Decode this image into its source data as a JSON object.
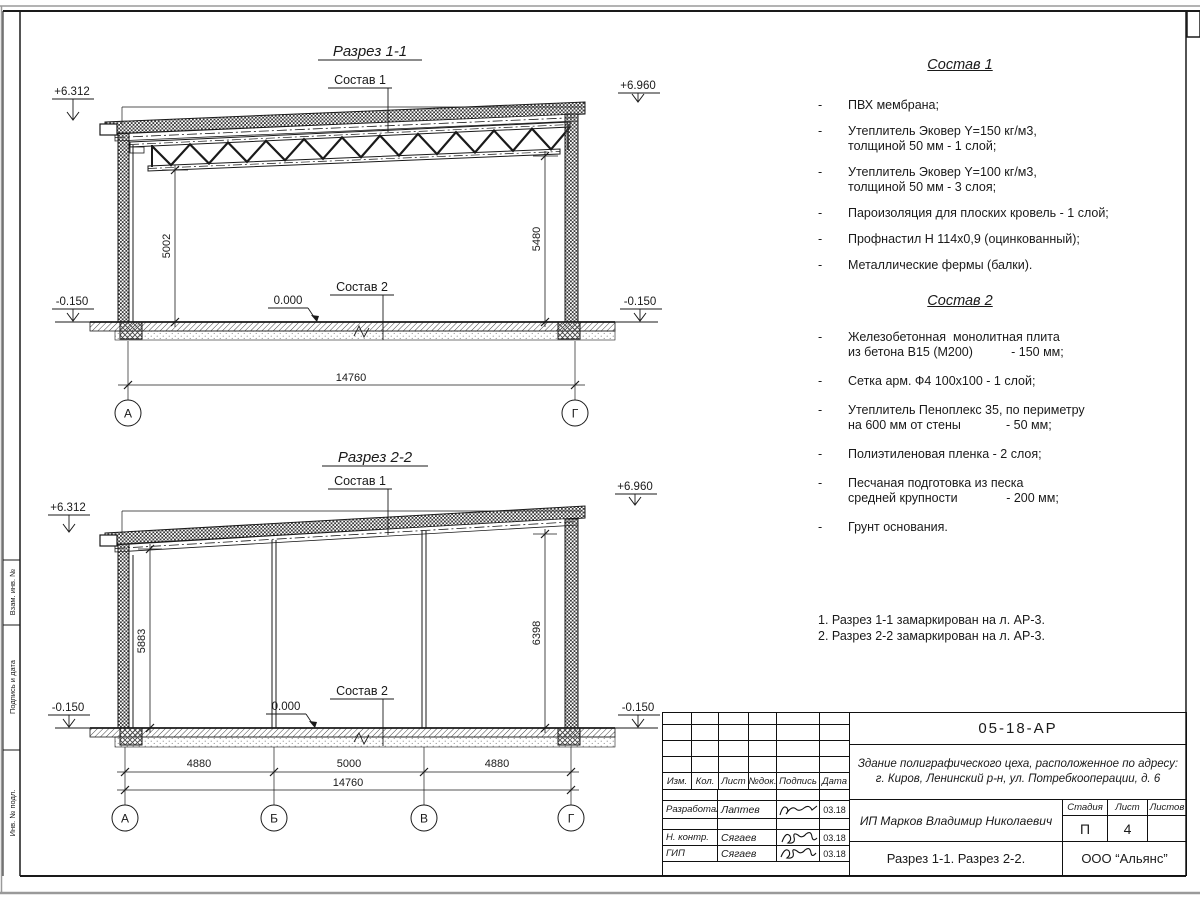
{
  "section1": {
    "title": "Разрез 1-1",
    "sostav1_label": "Состав 1",
    "sostav2_label": "Состав 2",
    "elev_top_left": "+6.312",
    "elev_top_right": "+6.960",
    "elev_bot_left": "-0.150",
    "elev_bot_right": "-0.150",
    "zero_mark": "0.000",
    "dim_left": "5002",
    "dim_right": "5480",
    "dim_total": "14760",
    "axis_left": "А",
    "axis_right": "Г"
  },
  "section2": {
    "title": "Разрез 2-2",
    "sostav1_label": "Состав 1",
    "sostav2_label": "Состав 2",
    "elev_top_left": "+6.312",
    "elev_top_right": "+6.960",
    "elev_bot_left": "-0.150",
    "elev_bot_right": "-0.150",
    "zero_mark": "0.000",
    "dim_left": "5883",
    "dim_right": "6398",
    "dim_span1": "4880",
    "dim_span2": "5000",
    "dim_span3": "4880",
    "dim_total": "14760",
    "axis_a": "А",
    "axis_b": "Б",
    "axis_v": "В",
    "axis_g": "Г"
  },
  "sostav1": {
    "title": "Состав 1",
    "dash": "-",
    "items": [
      "ПВХ мембрана;",
      "Утеплитель Эковер Y=150 кг/м3,\nтолщиной 50 мм - 1 слой;",
      "Утеплитель Эковер Y=100 кг/м3,\nтолщиной 50 мм - 3 слоя;",
      "Пароизоляция для плоских кровель - 1 слой;",
      "Профнастил Н 114х0,9 (оцинкованный);",
      "Металлические фермы (балки)."
    ]
  },
  "sostav2": {
    "title": "Состав 2",
    "dash": "-",
    "items": [
      "Железобетонная  монолитная плита\nиз бетона В15 (М200)           - 150 мм;",
      "Сетка арм. Ф4 100х100 - 1 слой;",
      "Утеплитель Пеноплекс 35, по периметру\nна 600 мм от стены             - 50 мм;",
      "Полиэтиленовая пленка - 2 слоя;",
      "Песчаная подготовка из песка\nсредней крупности              - 200 мм;",
      "Грунт основания."
    ]
  },
  "notes": {
    "line1": "1. Разрез 1-1 замаркирован на л. АР-3.",
    "line2": "2. Разрез 2-2 замаркирован на л. АР-3."
  },
  "margin_strip": {
    "label1": "Взам. инв. №",
    "label2": "Подпись и дата",
    "label3": "Инв. № подл."
  },
  "titleblock": {
    "doc_code": "05-18-АР",
    "object_line1": "Здание полиграфического цеха, расположенное по адресу:",
    "object_line2": "г. Киров,  Ленинский р-н, ул. Потребкооперации, д. 6",
    "col_izm": "Изм.",
    "col_kol": "Кол.",
    "col_list": "Лист",
    "col_ndok": "№док.",
    "col_podpis": "Подпись",
    "col_data": "Дата",
    "row1_role": "Разработал",
    "row1_name": "Лаптев",
    "row1_date": "03.18",
    "row2_role": "Н. контр.",
    "row2_name": "Сягаев",
    "row2_date": "03.18",
    "row3_role": "ГИП",
    "row3_name": "Сягаев",
    "row3_date": "03.18",
    "client": "ИП Марков Владимир Николаевич",
    "stage_label": "Стадия",
    "list_label": "Лист",
    "listov_label": "Листов",
    "stage_value": "П",
    "list_value": "4",
    "listov_value": "",
    "drawing_title": "Разрез 1-1. Разрез 2-2.",
    "company": "ООО “Альянс”"
  }
}
